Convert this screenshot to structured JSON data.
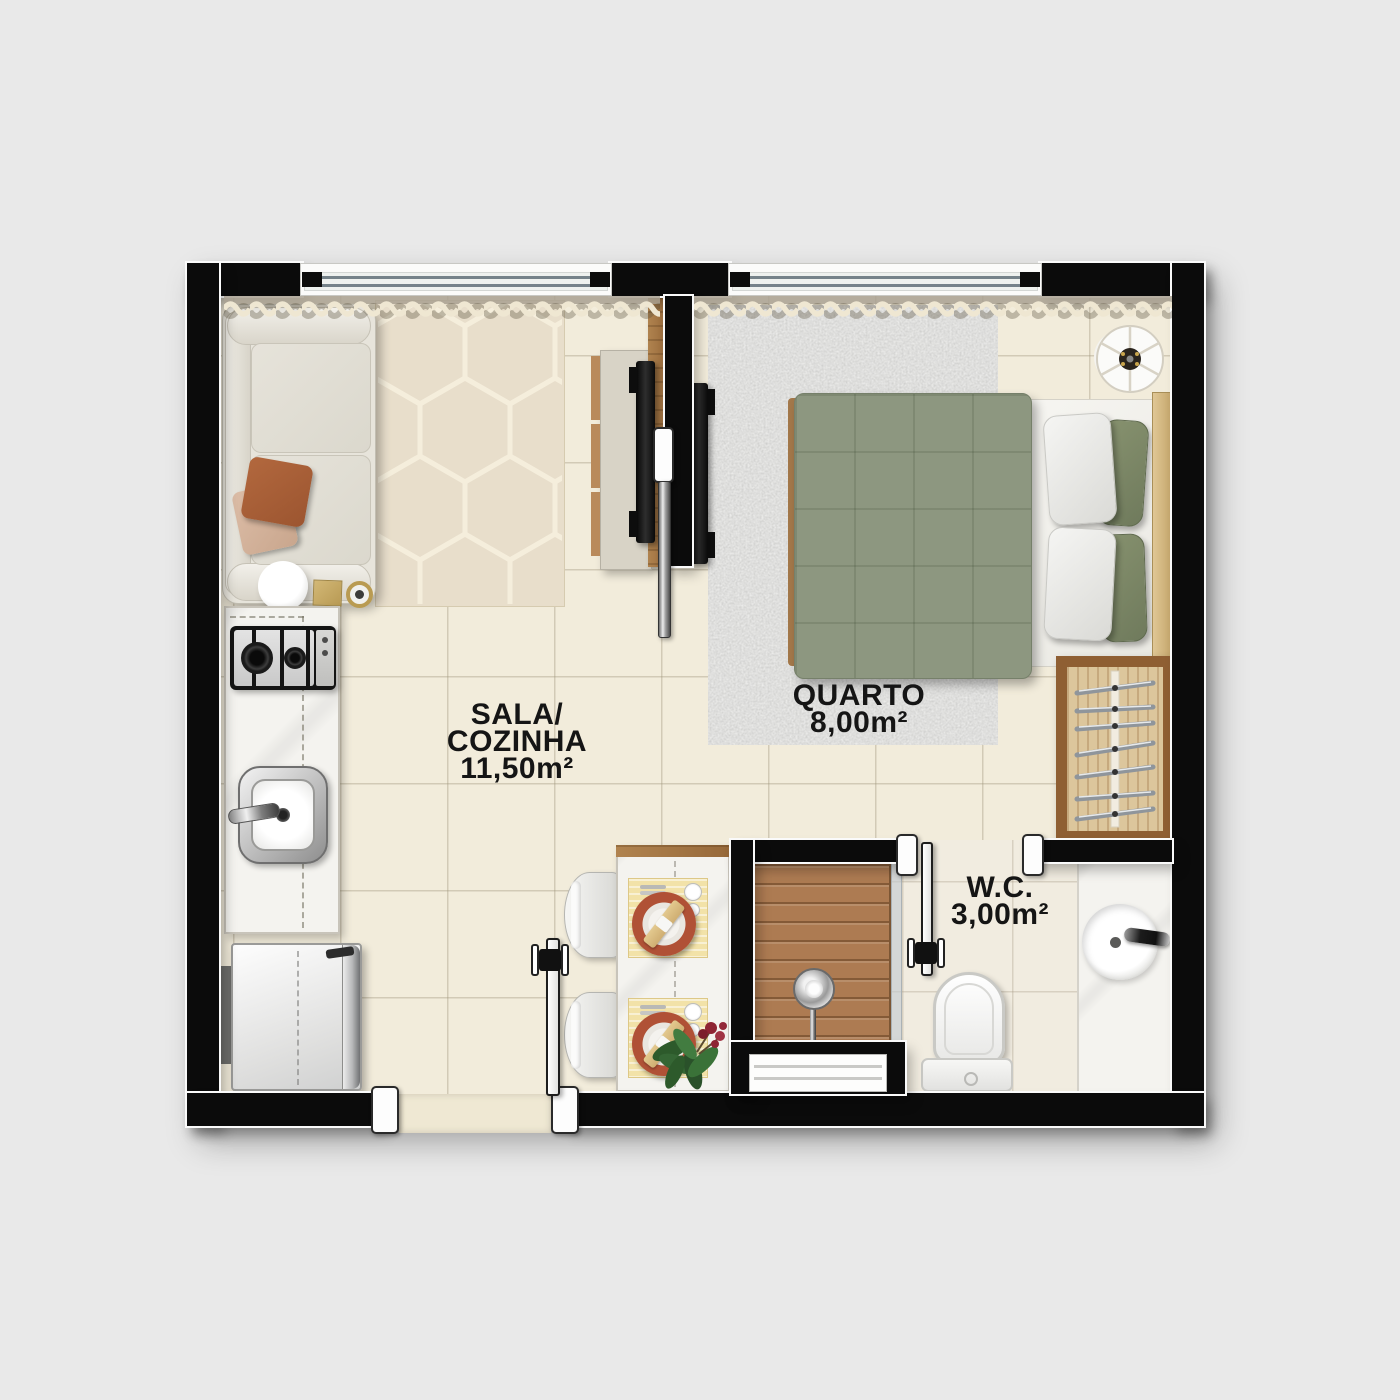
{
  "title": "Apartment floor plan",
  "rooms": [
    {
      "id": "sala-cozinha",
      "line1": "SALA/",
      "line2": "COZINHA",
      "area": "11,50m²"
    },
    {
      "id": "quarto",
      "line1": "QUARTO",
      "area": "8,00m²"
    },
    {
      "id": "wc",
      "line1": "W.C.",
      "area": "3,00m²"
    }
  ],
  "colors": {
    "background": "#e9e9e9",
    "wall": "#0b0b0b",
    "floor_tile": "#f2ecdb",
    "wc_floor": "#f1ece0",
    "hex_rug": "#e8decb",
    "shag_rug": "#d8d8d5",
    "duvet_green": "#8d9780",
    "pillow_green": "#7d896c",
    "wood": "#a3784a",
    "marble": "#f4f3ef",
    "terracotta_pillow": "#ac6138",
    "blush_pillow": "#d6b6a0",
    "placemat": "#f2e2a8",
    "plate": "#b05136",
    "curtain": "#efe7d2"
  },
  "furniture": [
    "sofa",
    "throw-pillows",
    "side-table",
    "hex-rug",
    "tv-rack",
    "tv-living",
    "tv-bedroom",
    "cooktop",
    "kitchen-sink",
    "kitchen-counter",
    "refrigerator",
    "dining-table",
    "dining-chairs",
    "place-settings",
    "plant",
    "entry-door",
    "sliding-door",
    "bed",
    "bed-pillows",
    "shag-rug",
    "floor-lamp",
    "wardrobe-with-hangers",
    "shower",
    "shower-head",
    "toilet",
    "vanity-sink",
    "bathroom-door",
    "windows",
    "curtains"
  ]
}
